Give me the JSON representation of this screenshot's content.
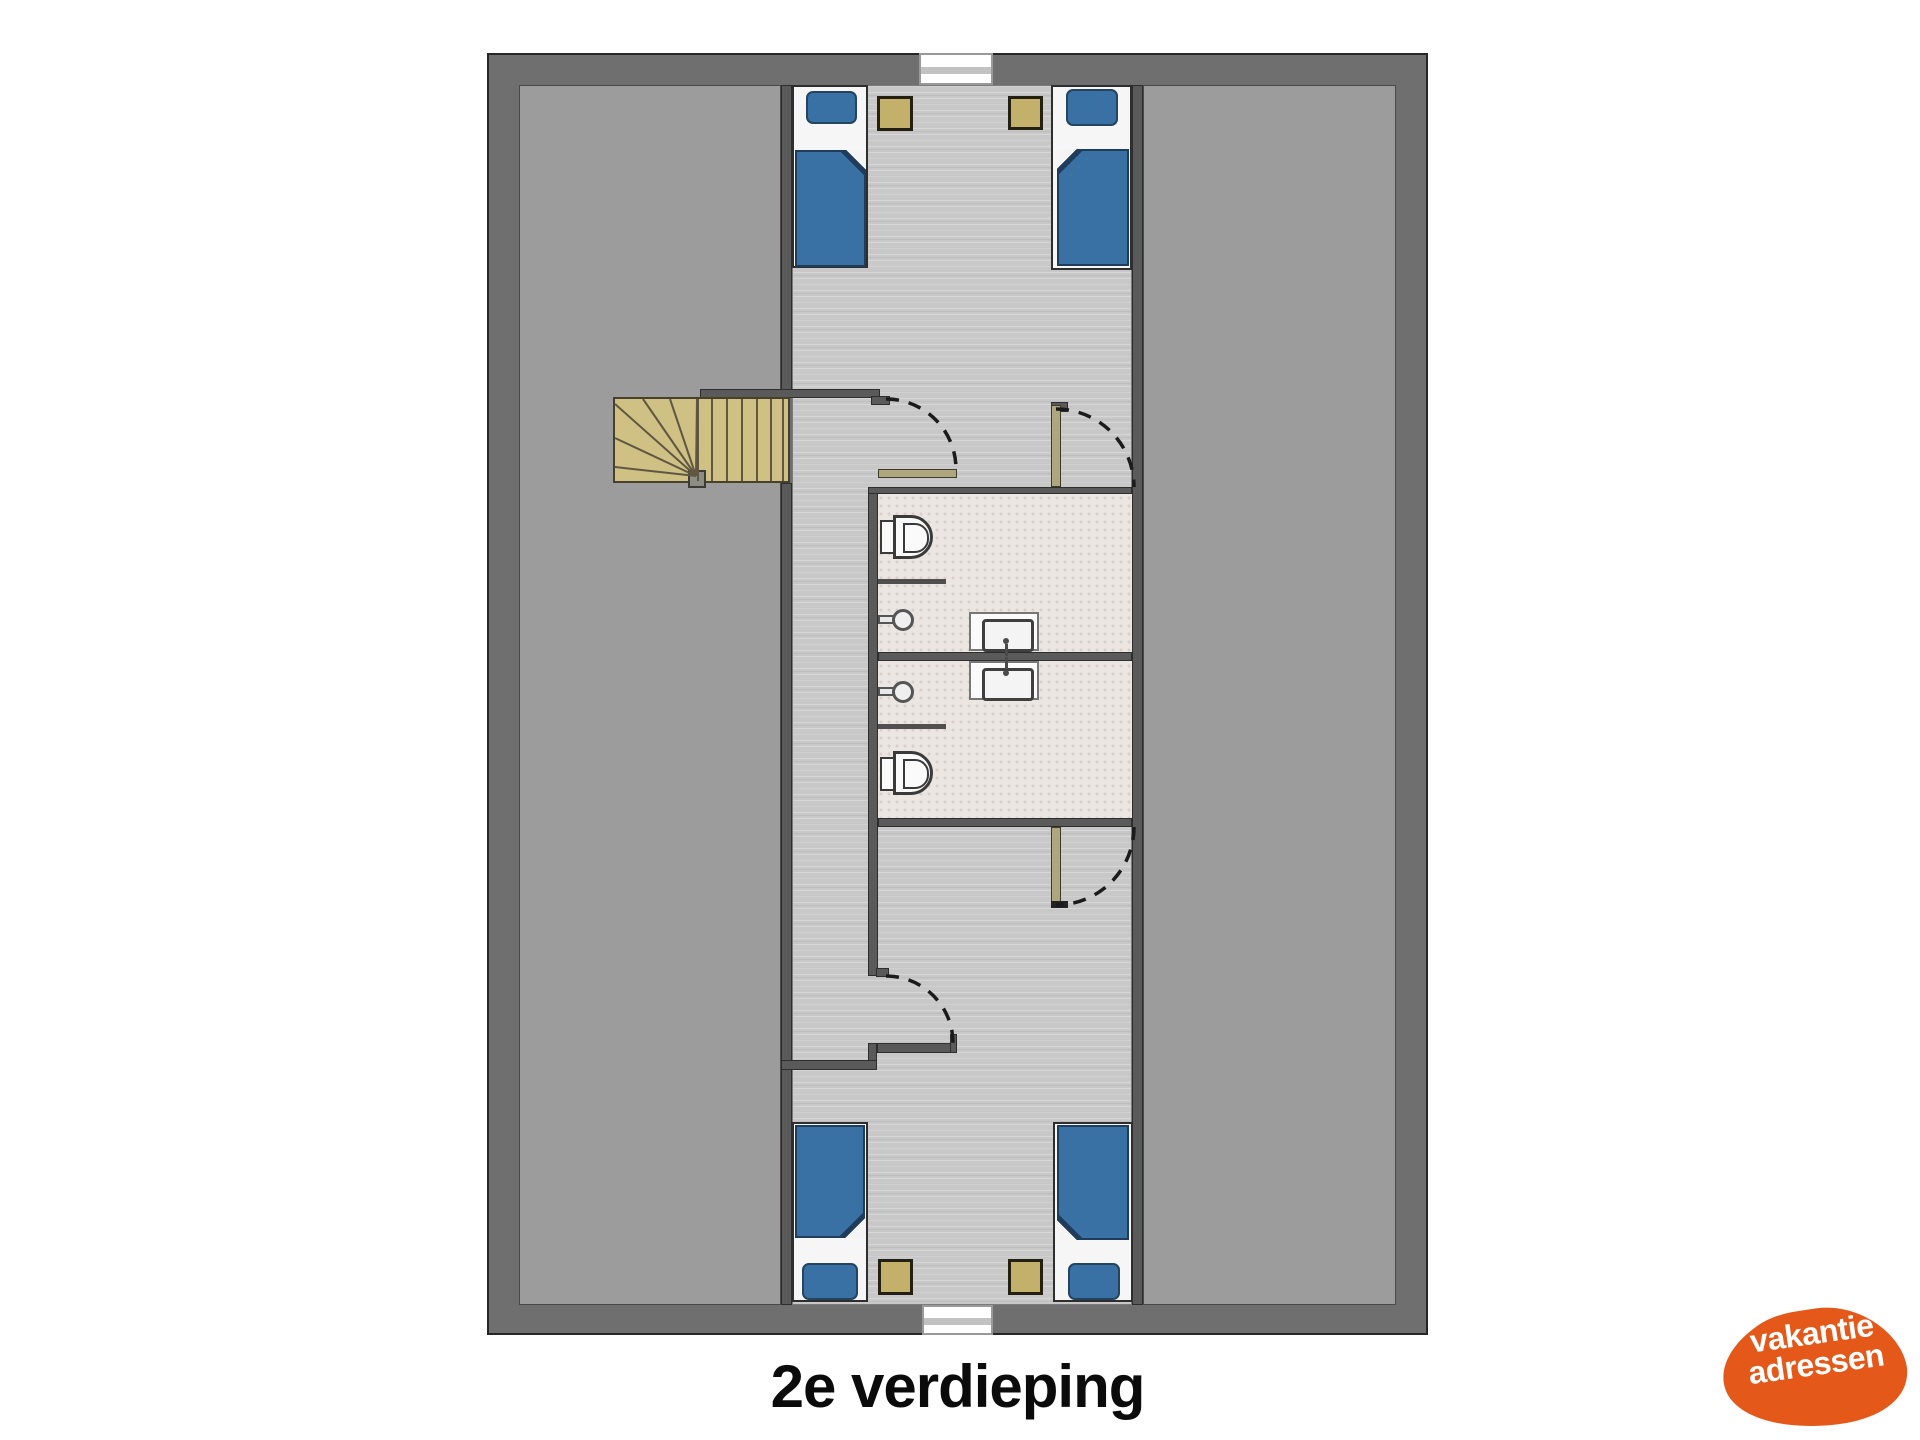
{
  "caption": {
    "text": "2e verdieping"
  },
  "logo": {
    "line1": "vakantie",
    "line2": "adressen",
    "bg_color": "#E4591A",
    "text_color": "#FFFFFF"
  },
  "palette": {
    "page_bg": "#FFFFFF",
    "outer_wall": "#6F6F6F",
    "wall_outline": "#262626",
    "inner_wall": "#5A5A5A",
    "side_room_floor": "#9C9C9C",
    "corridor_floor": "#C8C8C8",
    "bathroom_floor": "#ECE6E2",
    "bathroom_dot": "#D8CFC9",
    "bed_blanket": "#3A71A5",
    "bed_frame": "#F6F6F6",
    "nightstand": "#C2B06B",
    "stair_wood": "#CEC183",
    "door_leaf": "#ADA67F",
    "fixture_white": "#FAFAFA"
  },
  "plan": {
    "floor_label": "2e verdieping",
    "rooms": [
      "attic-left",
      "bedroom-top",
      "corridor",
      "bathroom-1",
      "bathroom-2",
      "bedroom-bottom",
      "attic-right"
    ],
    "fixtures": [
      "single-bed x4",
      "nightstand x4",
      "toilet x2",
      "wall-sink x2",
      "vanity-sink x2",
      "winder-staircase",
      "window x2",
      "door x4"
    ]
  }
}
